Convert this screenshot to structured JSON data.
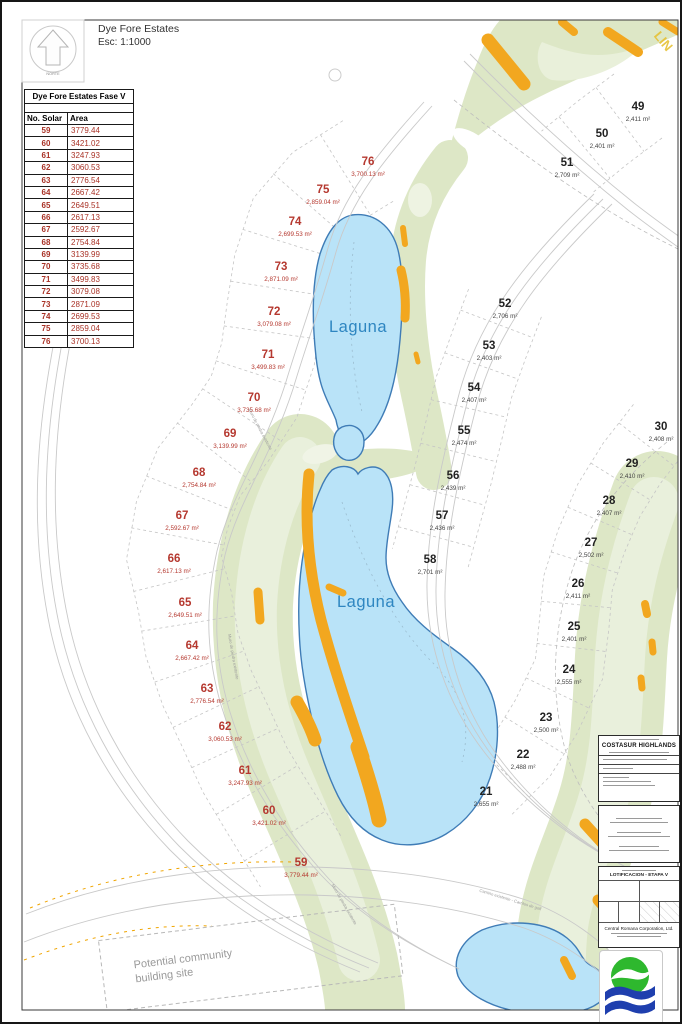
{
  "header": {
    "title": "Dye Fore Estates",
    "scale": "Esc: 1:1000"
  },
  "compass": {
    "label": "NORTE"
  },
  "table": {
    "title": "Dye Fore Estates Fase V",
    "columns": [
      "No. Solar",
      "Area"
    ],
    "rows": [
      {
        "no": "59",
        "area": "3779.44"
      },
      {
        "no": "60",
        "area": "3421.02"
      },
      {
        "no": "61",
        "area": "3247.93"
      },
      {
        "no": "62",
        "area": "3060.53"
      },
      {
        "no": "63",
        "area": "2776.54"
      },
      {
        "no": "64",
        "area": "2667.42"
      },
      {
        "no": "65",
        "area": "2649.51"
      },
      {
        "no": "66",
        "area": "2617.13"
      },
      {
        "no": "67",
        "area": "2592.67"
      },
      {
        "no": "68",
        "area": "2754.84"
      },
      {
        "no": "69",
        "area": "3139.99"
      },
      {
        "no": "70",
        "area": "3735.68"
      },
      {
        "no": "71",
        "area": "3499.83"
      },
      {
        "no": "72",
        "area": "3079.08"
      },
      {
        "no": "73",
        "area": "2871.09"
      },
      {
        "no": "74",
        "area": "2699.53"
      },
      {
        "no": "75",
        "area": "2859.04"
      },
      {
        "no": "76",
        "area": "3700.13"
      }
    ]
  },
  "map": {
    "columns": [
      {
        "id": "fase-v",
        "color": "#b5382f",
        "area_color": "#b5382f",
        "sep": 95,
        "lots": [
          {
            "no": "76",
            "area": "3,700.13 m²",
            "x": 366,
            "y": 159
          },
          {
            "no": "75",
            "area": "2,859.04 m²",
            "x": 321,
            "y": 187
          },
          {
            "no": "74",
            "area": "2,699.53 m²",
            "x": 293,
            "y": 219
          },
          {
            "no": "73",
            "area": "2,871.09 m²",
            "x": 279,
            "y": 264
          },
          {
            "no": "72",
            "area": "3,079.08 m²",
            "x": 272,
            "y": 309
          },
          {
            "no": "71",
            "area": "3,499.83 m²",
            "x": 266,
            "y": 352
          },
          {
            "no": "70",
            "area": "3,735.68 m²",
            "x": 252,
            "y": 395
          },
          {
            "no": "69",
            "area": "3,139.99 m²",
            "x": 228,
            "y": 431
          },
          {
            "no": "68",
            "area": "2,754.84 m²",
            "x": 197,
            "y": 470
          },
          {
            "no": "67",
            "area": "2,592.67 m²",
            "x": 180,
            "y": 513
          },
          {
            "no": "66",
            "area": "2,617.13 m²",
            "x": 172,
            "y": 556
          },
          {
            "no": "65",
            "area": "2,649.51 m²",
            "x": 183,
            "y": 600
          },
          {
            "no": "64",
            "area": "2,667.42 m²",
            "x": 190,
            "y": 643
          },
          {
            "no": "63",
            "area": "2,776.54 m²",
            "x": 205,
            "y": 686
          },
          {
            "no": "62",
            "area": "3,060.53 m²",
            "x": 223,
            "y": 724
          },
          {
            "no": "61",
            "area": "3,247.93 m²",
            "x": 243,
            "y": 768
          },
          {
            "no": "60",
            "area": "3,421.02 m²",
            "x": 267,
            "y": 808
          },
          {
            "no": "59",
            "area": "3,779.44 m²",
            "x": 299,
            "y": 860
          }
        ]
      },
      {
        "id": "north-east",
        "color": "#222222",
        "area_color": "#444444",
        "sep": 80,
        "lots": [
          {
            "no": "49",
            "area": "2,411 m²",
            "x": 636,
            "y": 104
          },
          {
            "no": "50",
            "area": "2,401 m²",
            "x": 600,
            "y": 131
          },
          {
            "no": "51",
            "area": "2,709 m²",
            "x": 565,
            "y": 160
          }
        ]
      },
      {
        "id": "east",
        "color": "#222222",
        "area_color": "#444444",
        "sep": 78,
        "lots": [
          {
            "no": "52",
            "area": "2,706 m²",
            "x": 503,
            "y": 301
          },
          {
            "no": "53",
            "area": "2,403 m²",
            "x": 487,
            "y": 343
          },
          {
            "no": "54",
            "area": "2,407 m²",
            "x": 472,
            "y": 385
          },
          {
            "no": "55",
            "area": "2,474 m²",
            "x": 462,
            "y": 428
          },
          {
            "no": "56",
            "area": "2,439 m²",
            "x": 451,
            "y": 473
          },
          {
            "no": "57",
            "area": "2,436 m²",
            "x": 440,
            "y": 513
          },
          {
            "no": "58",
            "area": "2,701 m²",
            "x": 428,
            "y": 557
          }
        ]
      },
      {
        "id": "south-east",
        "color": "#222222",
        "area_color": "#444444",
        "sep": 70,
        "lots": [
          {
            "no": "30",
            "area": "2,408 m²",
            "x": 659,
            "y": 424
          },
          {
            "no": "29",
            "area": "2,410 m²",
            "x": 630,
            "y": 461
          },
          {
            "no": "28",
            "area": "2,407 m²",
            "x": 607,
            "y": 498
          },
          {
            "no": "27",
            "area": "2,502 m²",
            "x": 589,
            "y": 540
          },
          {
            "no": "26",
            "area": "2,411 m²",
            "x": 576,
            "y": 581
          },
          {
            "no": "25",
            "area": "2,401 m²",
            "x": 572,
            "y": 624
          },
          {
            "no": "24",
            "area": "2,555 m²",
            "x": 567,
            "y": 667
          },
          {
            "no": "23",
            "area": "2,500 m²",
            "x": 544,
            "y": 715
          },
          {
            "no": "22",
            "area": "2,488 m²",
            "x": 521,
            "y": 752
          },
          {
            "no": "21",
            "area": "2,655 m²",
            "x": 484,
            "y": 789
          }
        ]
      }
    ],
    "deco_labels": [
      {
        "text": "Laguna",
        "x": 356,
        "y": 330,
        "rotate": 0,
        "cls": "laguna"
      },
      {
        "text": "Laguna",
        "x": 364,
        "y": 605,
        "rotate": 0,
        "cls": "laguna"
      },
      {
        "text": "Muro de piedra existente",
        "x": 257,
        "y": 428,
        "rotate": 62,
        "cls": "tiny"
      },
      {
        "text": "Muro de piedra existente",
        "x": 230,
        "y": 655,
        "rotate": 80,
        "cls": "tiny"
      },
      {
        "text": "Muro de piedra existente",
        "x": 341,
        "y": 903,
        "rotate": 60,
        "cls": "tiny"
      },
      {
        "text": "Camino existente - Carritos de golf",
        "x": 508,
        "y": 899,
        "rotate": 17,
        "cls": "tiny"
      },
      {
        "text": "LIN",
        "x": 658,
        "y": 42,
        "rotate": 50,
        "cls": "lin"
      }
    ],
    "note": {
      "line1": "Potential community",
      "line2": "building site"
    }
  },
  "titleblock": {
    "project": "COSTASUR HIGHLANDS",
    "stage": "LOTIFICACION - ETAPA V",
    "company": "Central Romana Corporation, Ltd."
  },
  "colors": {
    "laguna_fill": "#b9e3f8",
    "laguna_stroke": "#3f7cb6",
    "fairway": "#dde7c6",
    "fairway_light": "#e9f0da",
    "bunker": "#f2a71f",
    "fase_v_red": "#b5382f"
  }
}
